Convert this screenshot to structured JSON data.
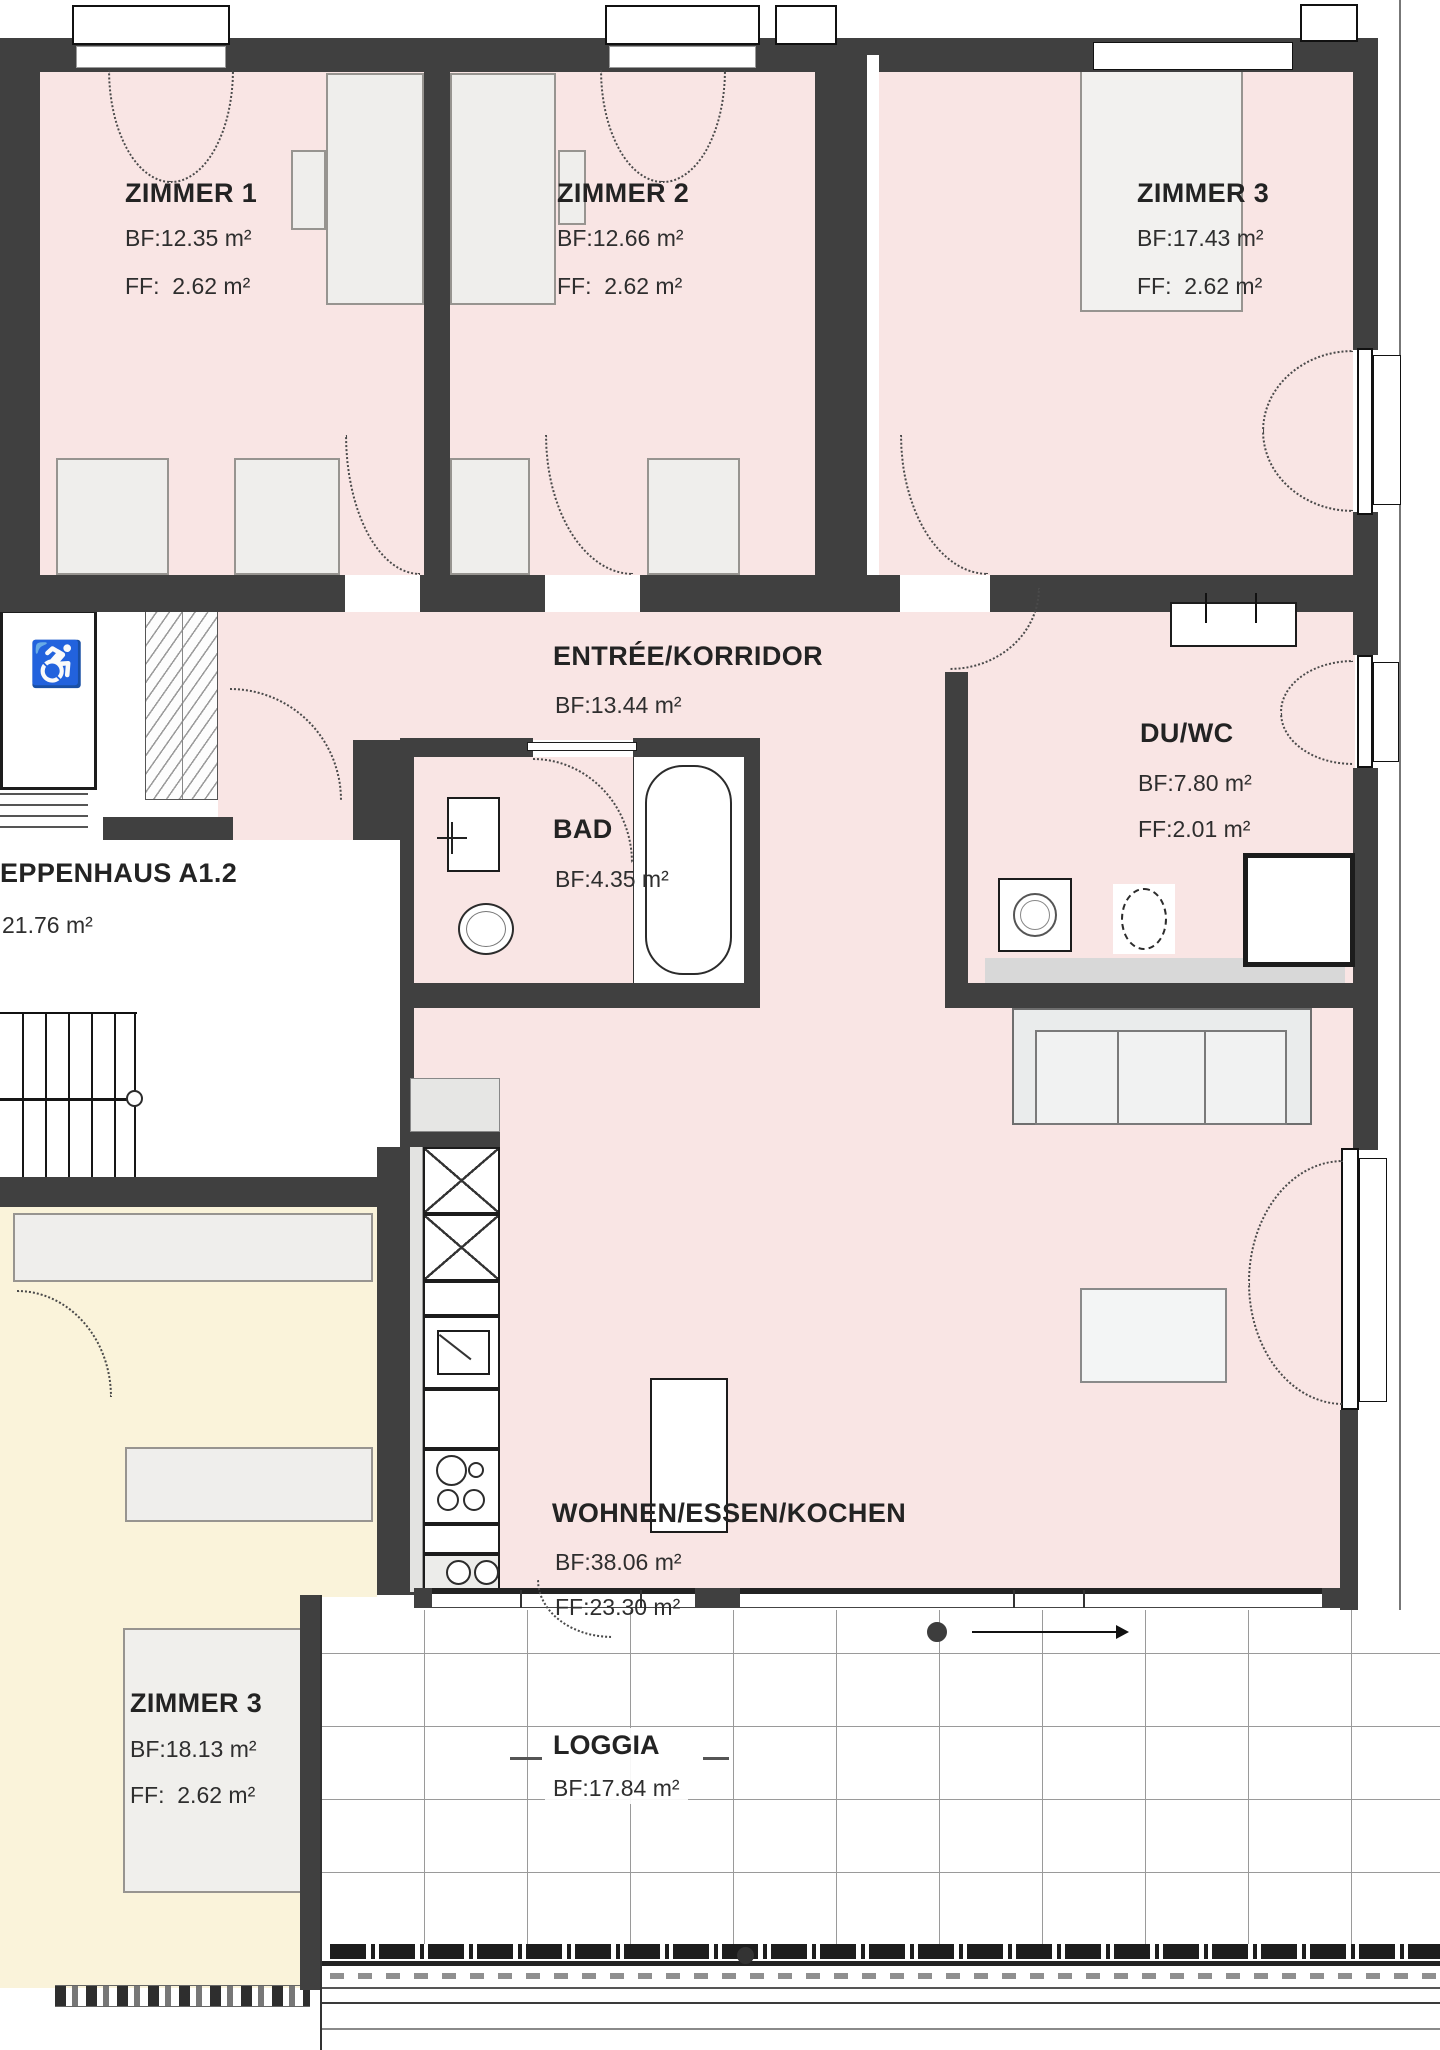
{
  "rooms": {
    "zimmer1": {
      "title": "ZIMMER 1",
      "bf": "BF:12.35 m²",
      "ff": "FF:  2.62 m²"
    },
    "zimmer2": {
      "title": "ZIMMER 2",
      "bf": "BF:12.66 m²",
      "ff": "FF:  2.62 m²"
    },
    "zimmer3_top": {
      "title": "ZIMMER 3",
      "bf": "BF:17.43 m²",
      "ff": "FF:  2.62 m²"
    },
    "entree": {
      "title": "ENTRÉE/KORRIDOR",
      "bf": "BF:13.44 m²"
    },
    "bad": {
      "title": "BAD",
      "bf": "BF:4.35 m²"
    },
    "duwc": {
      "title": "DU/WC",
      "bf": "BF:7.80 m²",
      "ff": "FF:2.01 m²"
    },
    "treppenhaus": {
      "title": "EPPENHAUS A1.2",
      "area": "21.76 m²"
    },
    "wohnen": {
      "title": "WOHNEN/ESSEN/KOCHEN",
      "bf": "BF:38.06 m²",
      "ff": "FF:23.30 m²"
    },
    "zimmer3_left": {
      "title": "ZIMMER 3",
      "bf": "BF:18.13 m²",
      "ff": "FF:  2.62 m²"
    },
    "loggia": {
      "title": "LOGGIA",
      "bf": "BF:17.84 m²"
    }
  },
  "icons": {
    "wheelchair": "♿"
  },
  "colors": {
    "wall": "#404040",
    "room_pink": "#f9e5e4",
    "room_yellow": "#faf3da",
    "furniture": "#efeeec"
  }
}
